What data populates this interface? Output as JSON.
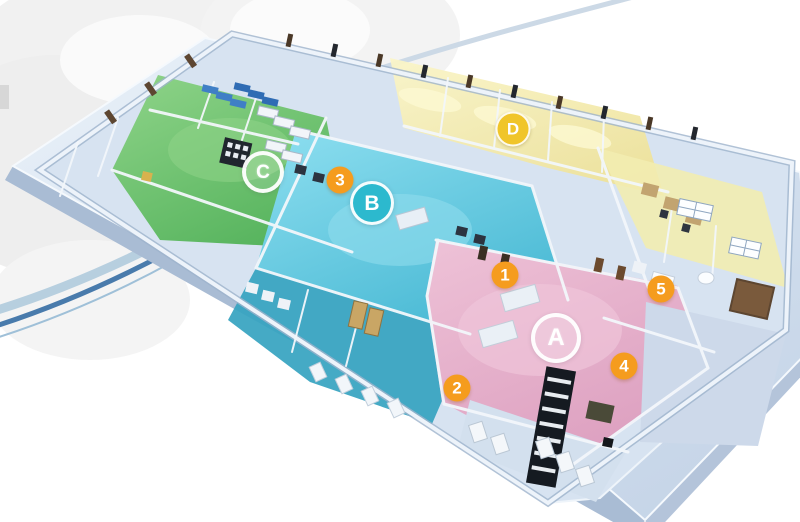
{
  "markers": {
    "zone_labels": [
      {
        "label": "A",
        "style": "outline-ring",
        "color": "#ffffff"
      },
      {
        "label": "B",
        "style": "filled",
        "color": "#2cb9ce"
      },
      {
        "label": "C",
        "style": "outline-ring",
        "color": "#ffffff"
      },
      {
        "label": "D",
        "style": "filled",
        "color": "#f0c52a"
      }
    ],
    "room_numbers": [
      {
        "label": "1"
      },
      {
        "label": "2"
      },
      {
        "label": "3"
      },
      {
        "label": "4"
      },
      {
        "label": "5"
      }
    ],
    "room_number_color": "#f59c1e"
  },
  "zones": [
    {
      "id": "zone-a",
      "marker": "A",
      "floor_color": "#e3aec9"
    },
    {
      "id": "zone-b",
      "marker": "B",
      "floor_color": "#62c8dd"
    },
    {
      "id": "zone-c",
      "marker": "C",
      "floor_color": "#6fc46b"
    },
    {
      "id": "zone-d",
      "marker": "D",
      "floor_color": "#f2ecb0"
    }
  ],
  "palette": {
    "background": "#ffffff",
    "platform": "#ccd9ea",
    "platform_side": "#a9bcd4",
    "wall_highlight": "#f3f7fb",
    "teal_rooms": "#35a3c0",
    "arc_blue_dark": "#497bac",
    "arc_blue_light": "#b7cfdf",
    "bed_blue": "#3f7fc6",
    "door_brown": "#5d4631",
    "desk_tan": "#c9a665"
  }
}
